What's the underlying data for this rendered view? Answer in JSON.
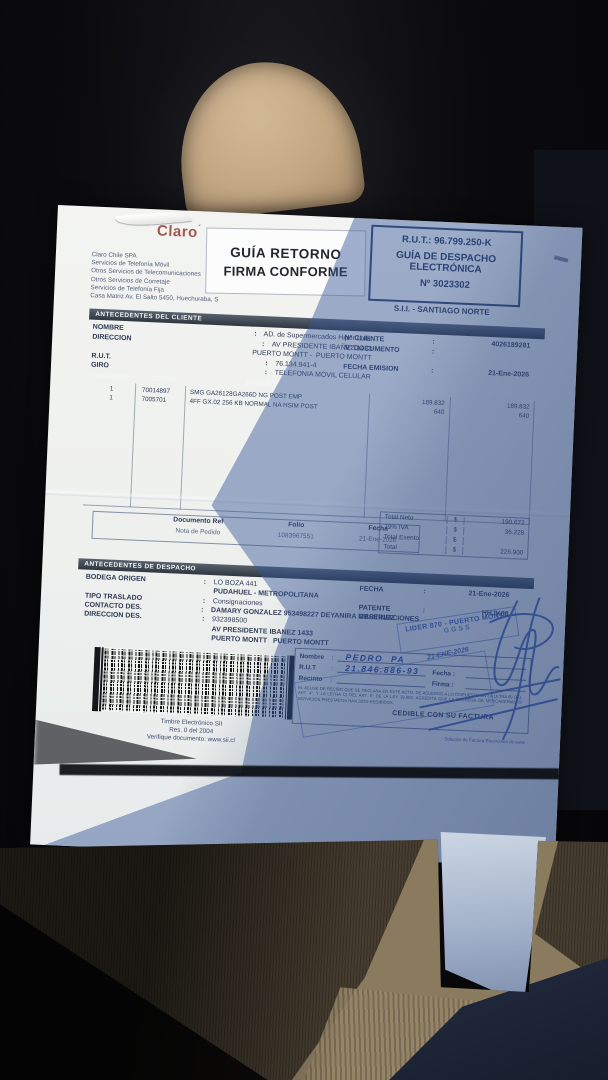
{
  "scene": {
    "colors": {
      "claro_brand": "#a4574e",
      "stamp_ink_blue": "#3a5cb0",
      "paper_shadow_tint": "#345696",
      "headrest_beige": "#c9af8e",
      "knit_khaki": "#8a7b5f",
      "denim_navy": "#2a3450"
    }
  },
  "punct": {
    "colon": ":"
  },
  "document": {
    "brand": {
      "name": "Claro",
      "tick": "´"
    },
    "company": {
      "lines": [
        "Claro Chile SPA",
        "Servicios de Telefonía Móvil",
        "Otros Servicios de Telecomunicaciones",
        "Otros Servicios de Corretaje",
        "Servicios de Telefonía Fija",
        "Casa Matriz Av. El Salto 5450, Huechuraba, S"
      ]
    },
    "stamp_top": {
      "line1": "GUÍA RETORNO",
      "line2": "FIRMA CONFORME"
    },
    "rut_box": {
      "rut": "R.U.T.: 96.799.250-K",
      "type1": "GUÍA DE DESPACHO",
      "type2": "ELECTRÓNICA",
      "number": "Nº 3023302"
    },
    "sii_office": "S.I.I. - SANTIAGO NORTE",
    "client": {
      "title": "ANTECEDENTES DEL CLIENTE",
      "left": [
        {
          "label": "NOMBRE",
          "colon": ":",
          "value": "AD. de Supermercados Hiper Ltda."
        },
        {
          "label": "DIRECCION",
          "colon": ":",
          "value": "AV PRESIDENTE IBAÑEZ 1433"
        },
        {
          "label": "",
          "colon": "",
          "value": "PUERTO MONTT -  PUERTO MONTT"
        },
        {
          "label": "R.U.T.",
          "colon": ":",
          "value": "76.134.941-4"
        },
        {
          "label": "GIRO",
          "colon": ":",
          "value": "TELEFONIA MÓVIL CELULAR"
        }
      ],
      "right": [
        {
          "label": "N° CLIENTE",
          "colon": ":",
          "value": "4026189281"
        },
        {
          "label": "N° DOCUMENTO",
          "colon": ":",
          "value": ""
        },
        {
          "label": "FECHA EMISION",
          "colon": ":",
          "value": "21-Ene-2026"
        }
      ]
    },
    "items": {
      "headers": [
        "CANTIDAD",
        "CODIGO",
        "DESCRIPCION",
        "PRECIO UNITARIO",
        "MONTO"
      ],
      "rows": [
        [
          "1",
          "70014897",
          "SMG GA26128GA266D NG POST EMP",
          "189.832",
          "189.832"
        ],
        [
          "1",
          "7005701",
          "4FF GX.02 256 KB NORMAL NA HSIM POST",
          "640",
          "640"
        ]
      ]
    },
    "docref": {
      "headers": [
        "Documento Ref",
        "Folio",
        "Fecha"
      ],
      "row": [
        "Nota de Pedido",
        "1083967551",
        "21-Ene-2026"
      ]
    },
    "totals": {
      "rows": [
        [
          "Total Neto",
          "$",
          "190.672"
        ],
        [
          "19% IVA",
          "$",
          "36.228"
        ],
        [
          "Total Exento",
          "$",
          ""
        ],
        [
          "Total",
          "$",
          "226.900"
        ]
      ]
    },
    "dispatch": {
      "title": "ANTECEDENTES DE DESPACHO",
      "left": [
        {
          "label": "BODEGA ORIGEN",
          "colon": ":",
          "value": "LO BOZA 441"
        },
        {
          "label": "",
          "colon": "",
          "value": "PUDAHUEL - METROPOLITANA"
        },
        {
          "label": "TIPO TRASLADO",
          "colon": ":",
          "value": "Consignaciones"
        },
        {
          "label": "CONTACTO DES.",
          "colon": ":",
          "value": "DAMARY GONZALEZ 953498227 DEYANIRA MARTINEZ"
        },
        {
          "label": "DIRECCION DES.",
          "colon": ":",
          "value": "932398500"
        },
        {
          "label": "",
          "colon": "",
          "value": "AV PRESIDENTE IBANEZ 1433"
        },
        {
          "label": "",
          "colon": "",
          "value": "PUERTO MONTT   PUERTO MONTT"
        }
      ],
      "right": [
        {
          "label": "FECHA",
          "colon": ":",
          "value": "21-Ene-2026"
        },
        {
          "label": "PATENTE",
          "colon": ":",
          "value": "HHJK63"
        },
        {
          "label": "OBSERVACIONES",
          "colon": "",
          "value": ""
        }
      ]
    },
    "stamp_lider": {
      "line1": "LIDER 870 - PUERTO MONTT",
      "line2": "GGSS"
    },
    "barcode": {
      "caption": [
        "Timbre Electrónico SII",
        "Res. 0 del 2004",
        "Verifique documento: www.sii.cl"
      ]
    },
    "reception": {
      "nombre_label": "Nombre",
      "nombre_value": "PEDRO  PA",
      "rut_label": "R.U.T",
      "rut_value": "21.846.886-93",
      "recinto_label": "Recinto",
      "fecha_label": "Fecha :",
      "firma_label": "Firma :",
      "date_note": "21-ENE-2026",
      "legal": "EL ACUSE DE RECIBO QUE SE DECLARA EN ESTE ACTO, DE ACUERDO A LO DISPUESTO EN LA LETRA B) DEL ART. 4°, Y LA LETRA C) DEL ART. 5° DE LA LEY 19.983, ACREDITA QUE LA ENTREGA DE MERCADERIAS O SERVICIOS PRESTADOS HAN SIDO RECIBIDOS.",
      "cedible": "CEDIBLE CON SU FACTURA"
    },
    "footer": {
      "provider": "Solución de Factura Electrónica de www"
    }
  }
}
